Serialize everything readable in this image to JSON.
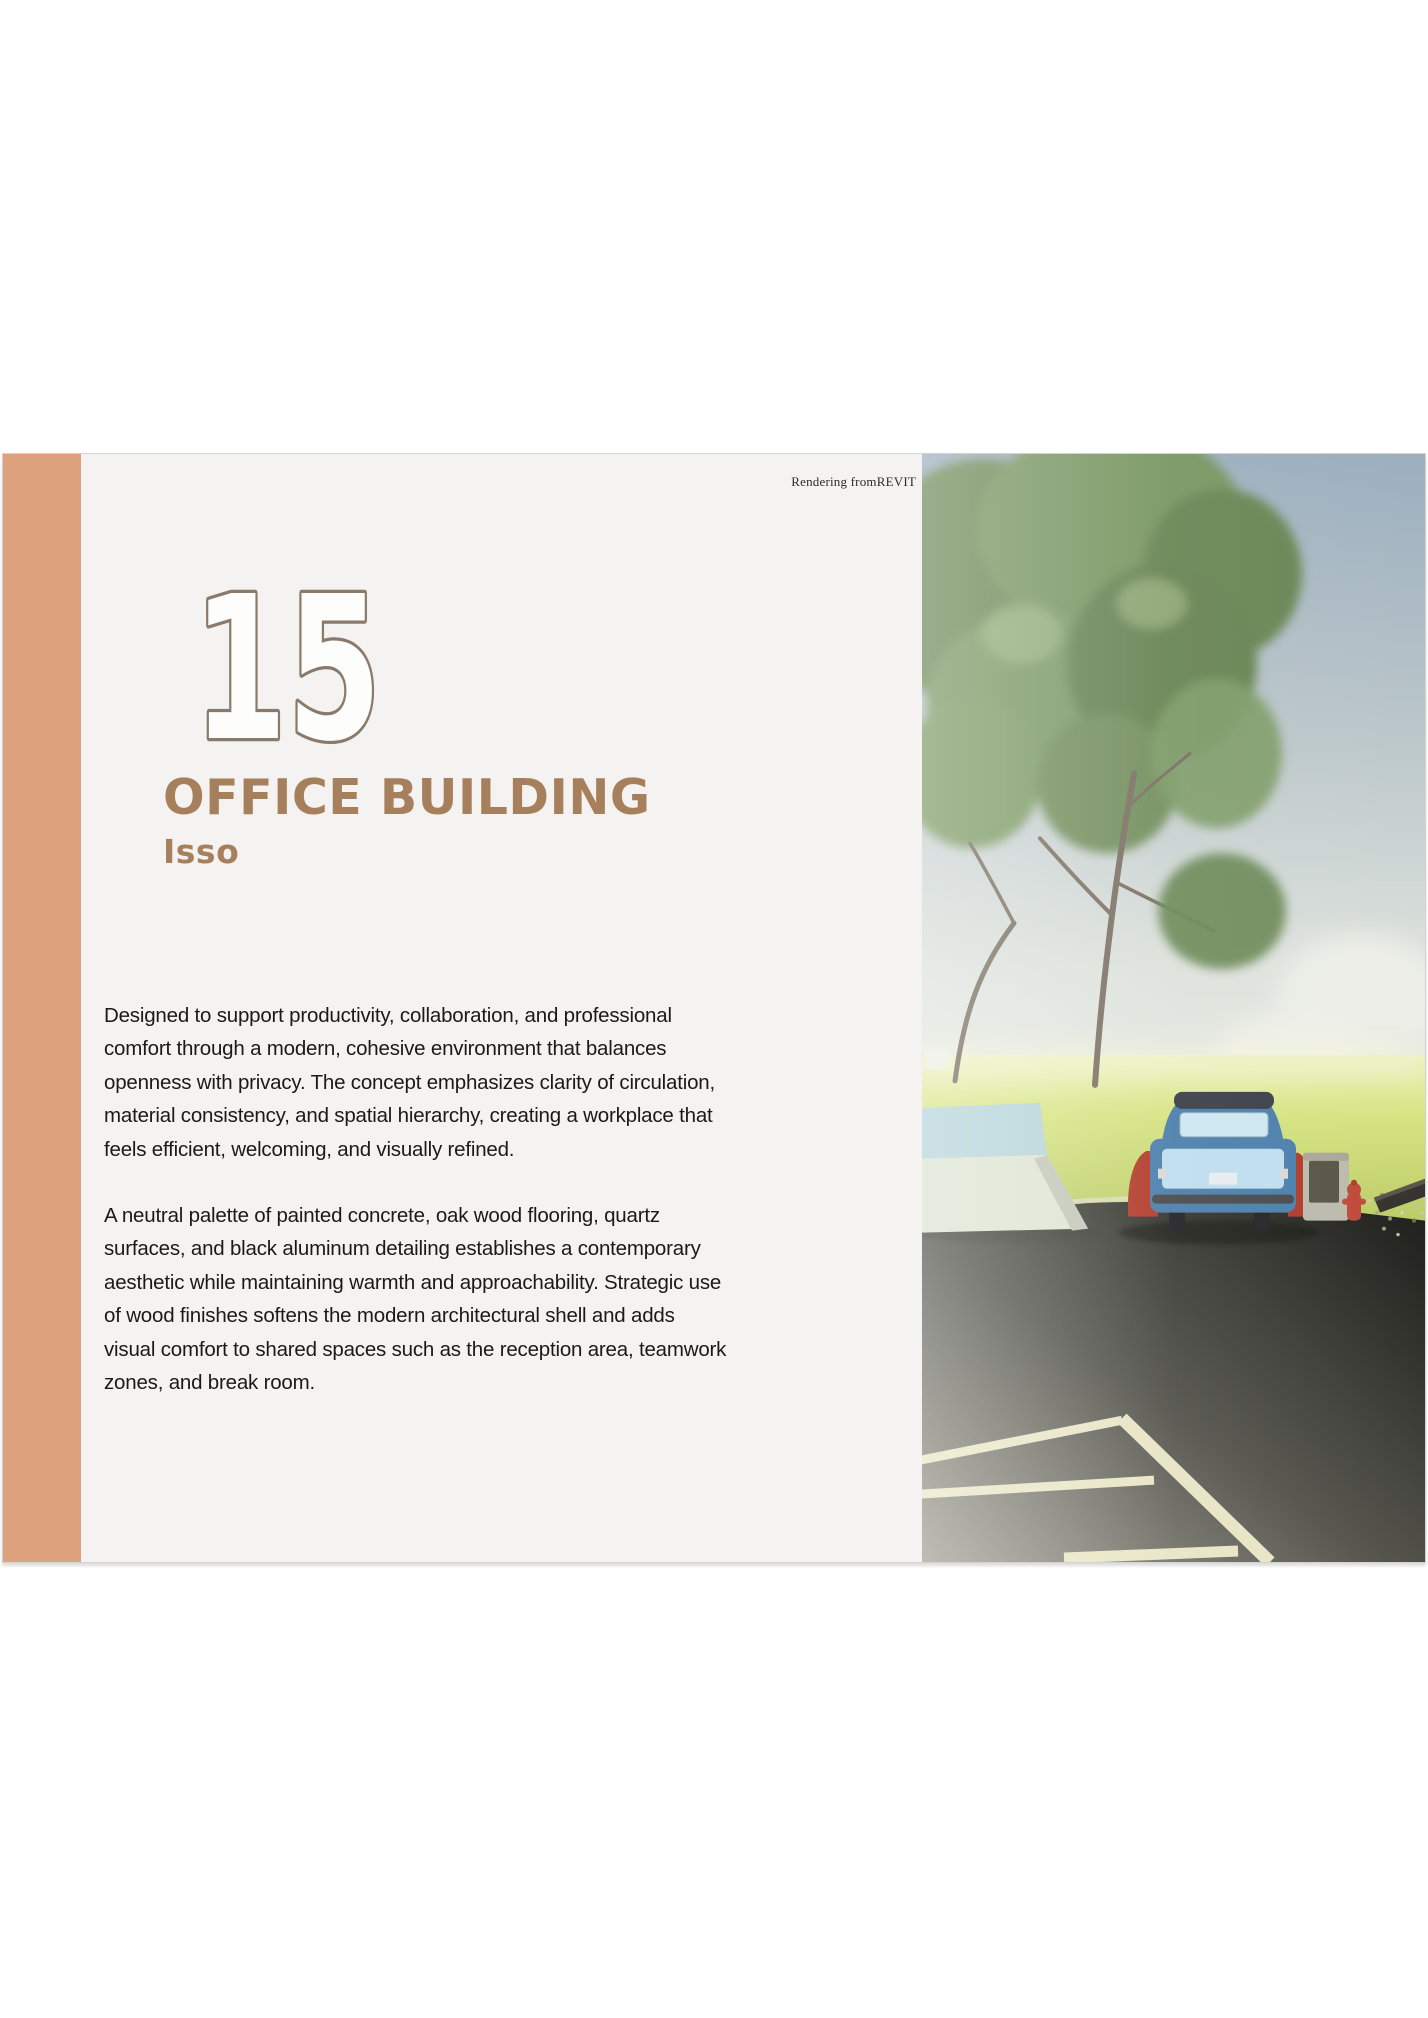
{
  "page": {
    "background": "#ffffff"
  },
  "slide": {
    "background": "#f5f3f1",
    "accent_color": "#dda17e",
    "border_color": "#d5d3d1",
    "credit": "Rendering fromREVIT",
    "number": "15",
    "number_fill": "#fdfdfc",
    "number_outline": "#8a7a6b",
    "title": "OFFICE BUILDING",
    "subtitle": "Isso",
    "heading_color": "#a67f5d",
    "body_text_color": "#1b1a18",
    "paragraphs": {
      "p1": "Designed to support productivity, collaboration, and professional comfort through a modern, cohesive environment that balances openness with privacy. The concept emphasizes clarity of circulation, material consistency, and spatial hierarchy, creating a workplace that feels efficient, welcoming, and visually refined.",
      "p2": "A neutral palette of painted concrete, oak wood flooring, quartz surfaces, and black aluminum detailing establishes a contemporary aesthetic while maintaining warmth and approachability. Strategic use of wood finishes softens the modern architectural shell and adds visual comfort to shared spaces such as the reception area, teamwork zones, and break room."
    },
    "rendering": {
      "label": "exterior-rendering-tree-lawn-car-parking-lot",
      "sky_top": "#9cafbf",
      "sky_horizon": "#e9eae2",
      "grass": "#c9da6e",
      "asphalt_light": "#a0a094",
      "asphalt_dark": "#1f1f1b",
      "parking_line": "#efeccb",
      "tree_green": "#74905e",
      "car_blue": "#4e80ad",
      "car_red": "#b23d2c",
      "hydrant_red": "#bf4a3b"
    }
  }
}
